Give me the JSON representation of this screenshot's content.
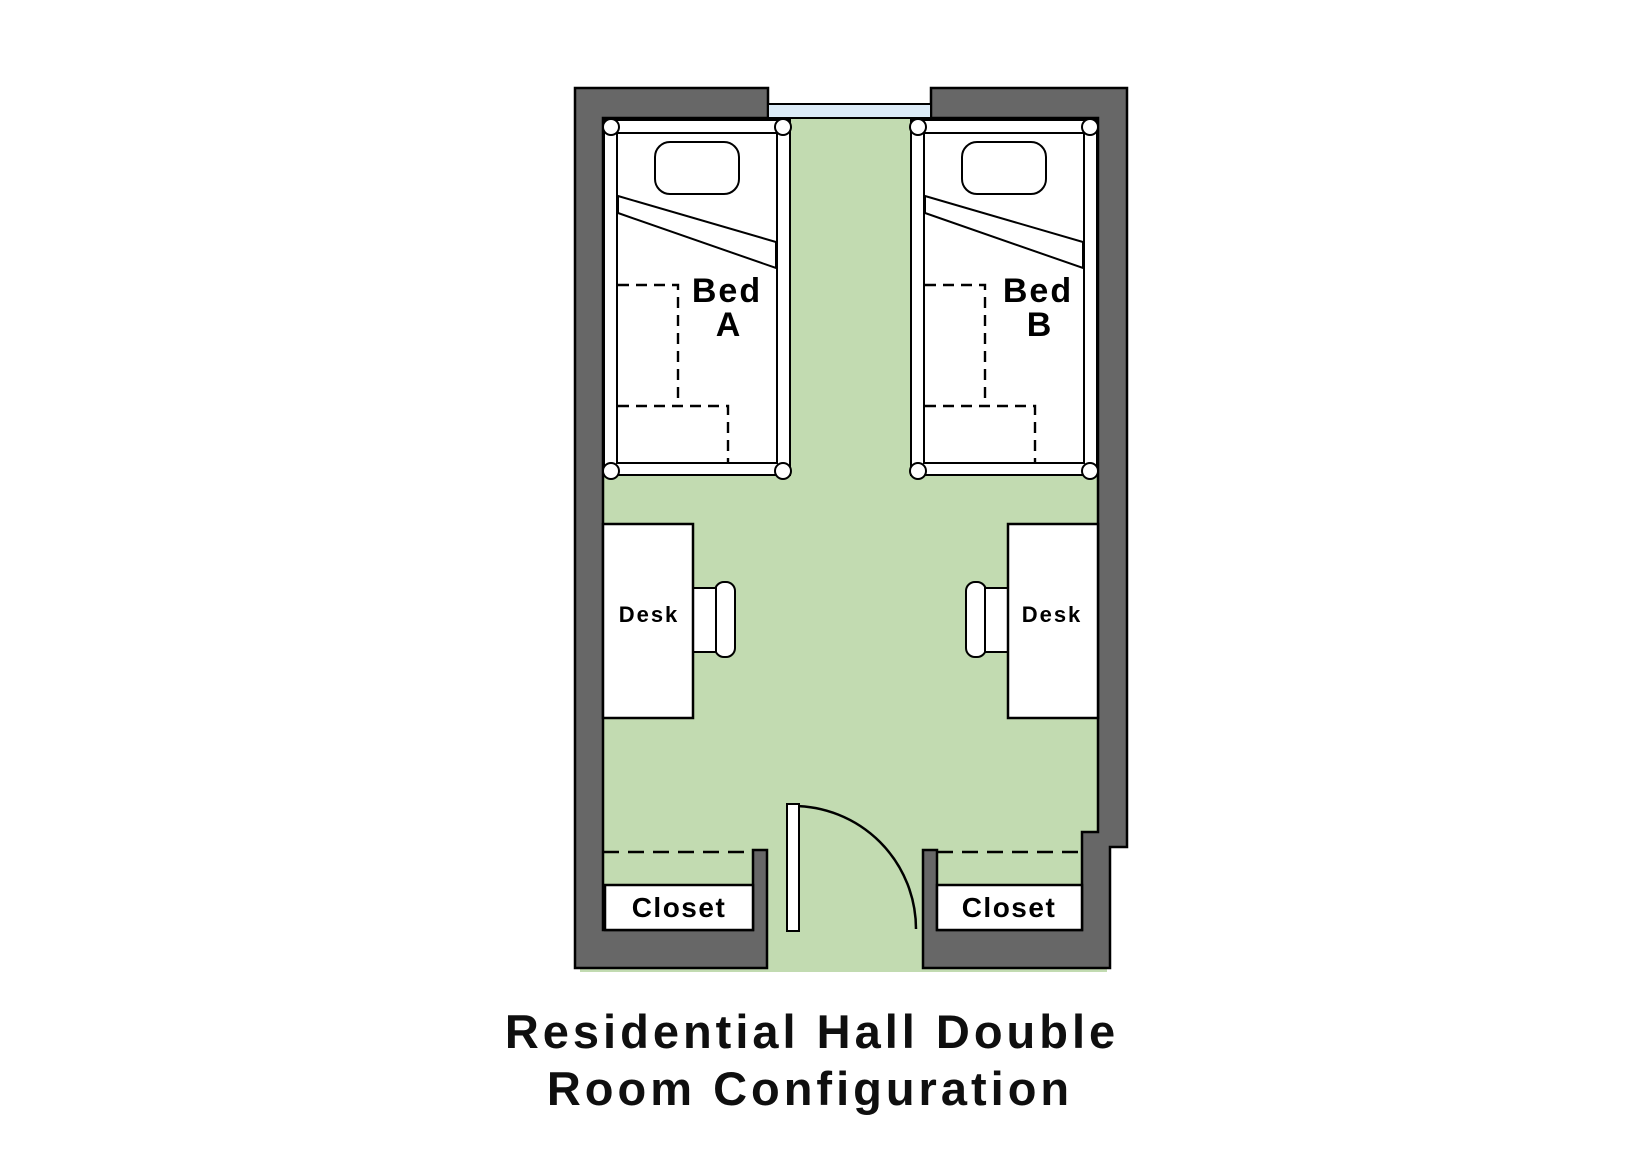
{
  "title": {
    "line1": "Residential Hall Double",
    "line2": "Room Configuration"
  },
  "colors": {
    "wall": "#676767",
    "floor": "#c2dbb1",
    "window_glass": "#dcebf7",
    "furniture": "#ffffff",
    "line": "#000000"
  },
  "plan": {
    "bed_a": {
      "line1": "Bed",
      "line2": "A"
    },
    "bed_b": {
      "line1": "Bed",
      "line2": "B"
    },
    "desk_a": {
      "label": "Desk"
    },
    "desk_b": {
      "label": "Desk"
    },
    "closet_left": {
      "label": "Closet"
    },
    "closet_right": {
      "label": "Closet"
    }
  }
}
